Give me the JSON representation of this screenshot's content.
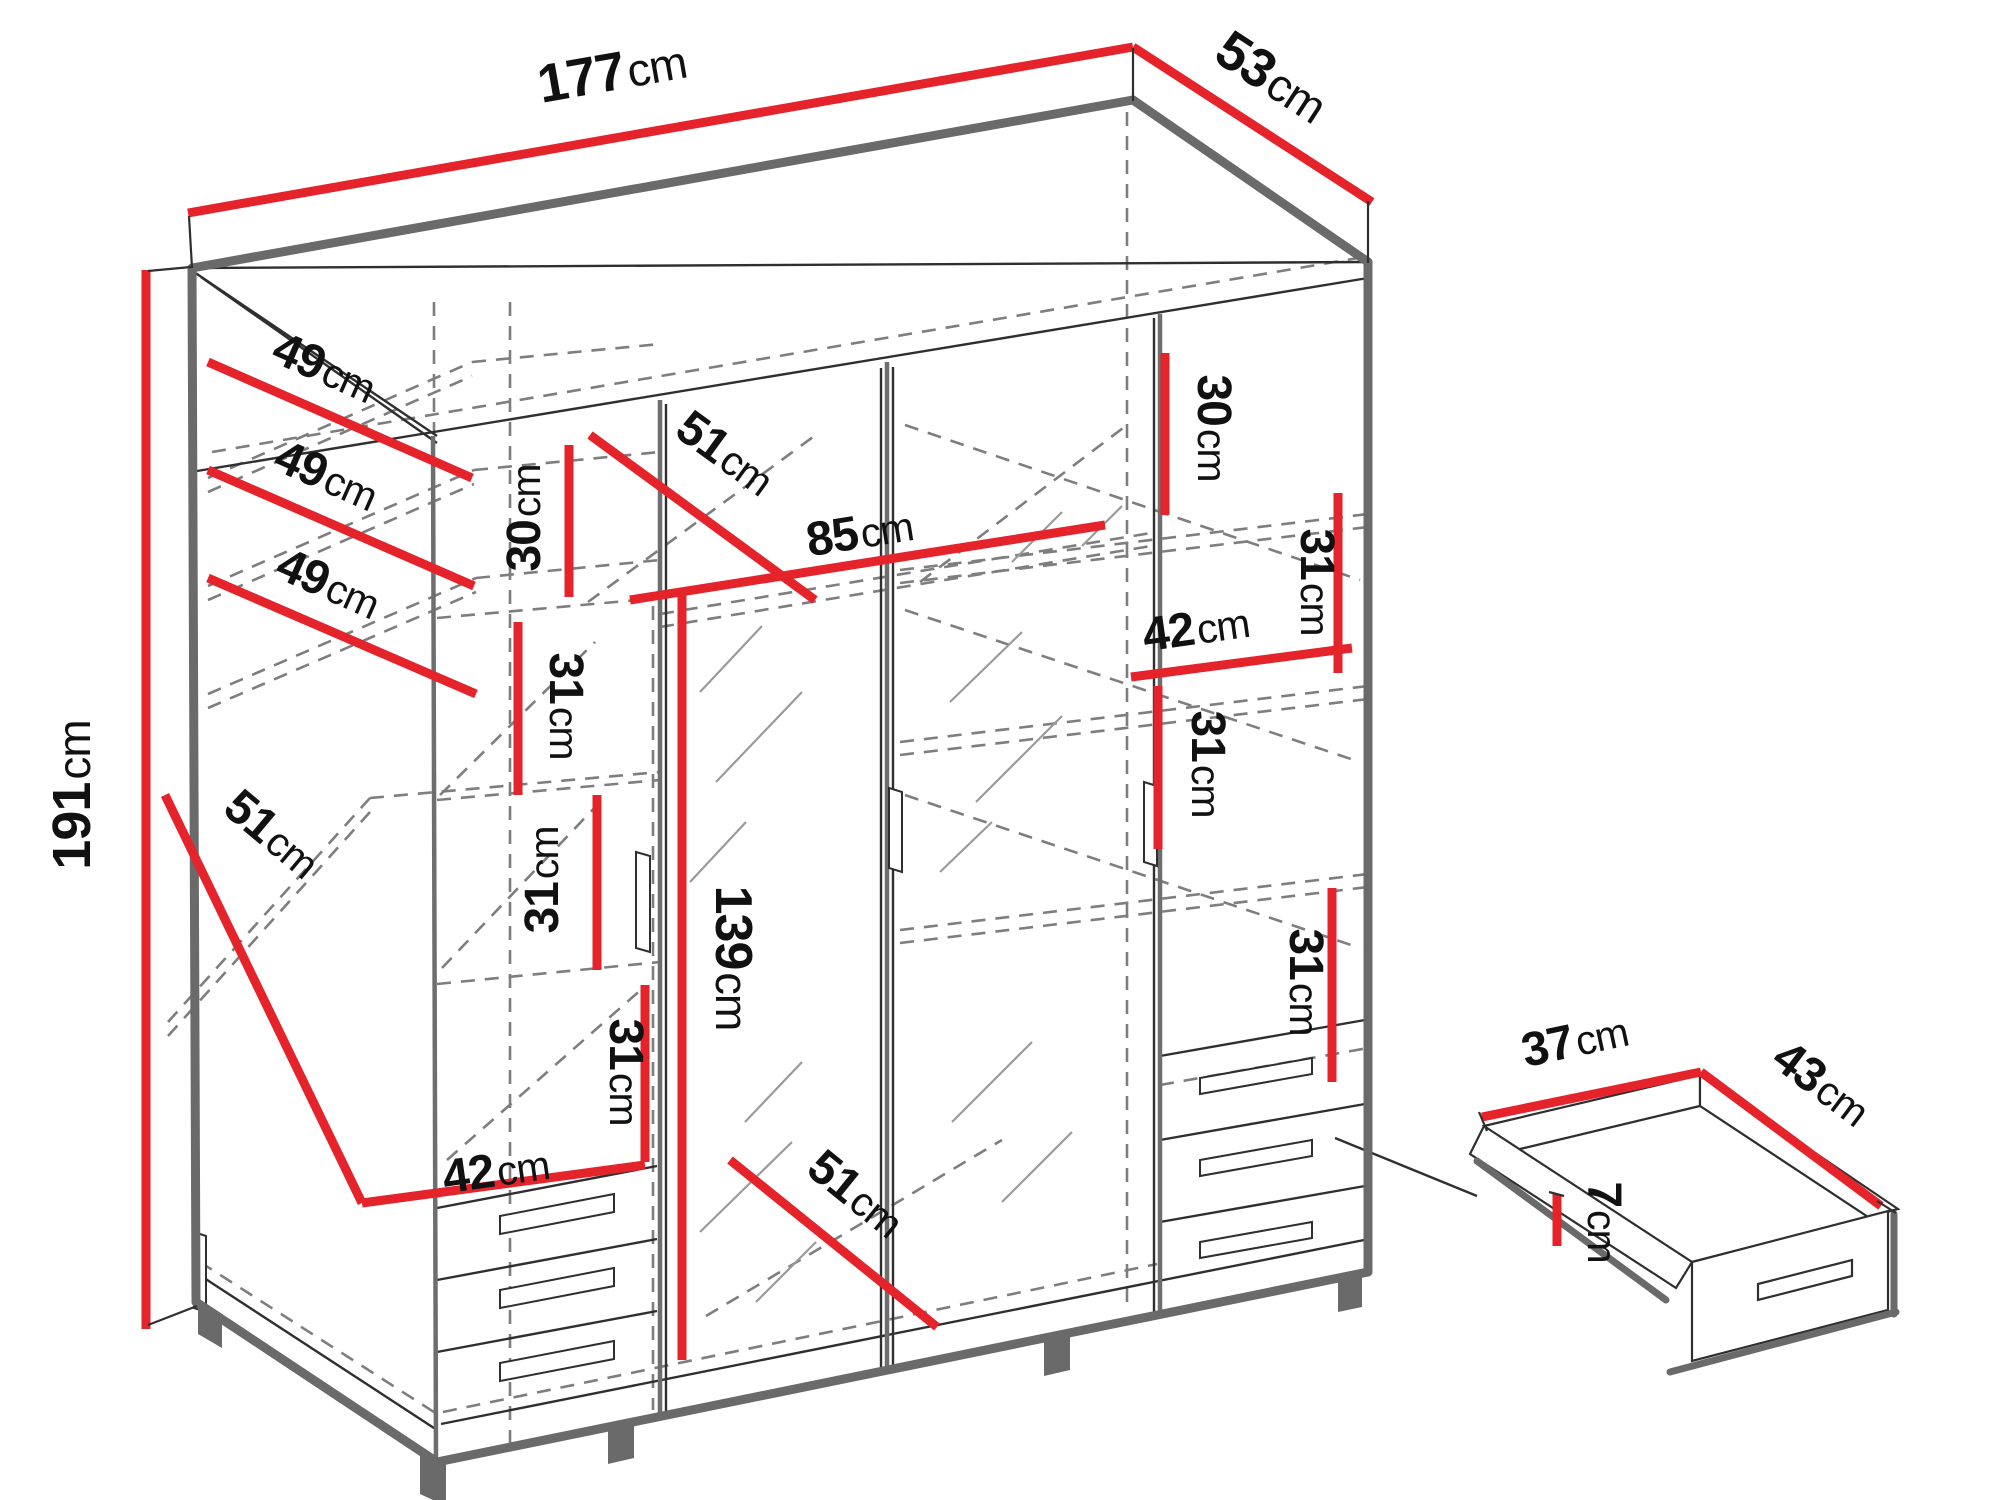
{
  "colors": {
    "red": "#e4232b",
    "thick_gray": "#6a6a6a",
    "thin_black": "#2f2f2f",
    "dash_gray": "#7e7e7e",
    "hatch_gray": "#9a9a9a"
  },
  "diagram": {
    "labels": [
      {
        "id": "width-total",
        "num": "177",
        "unit": "cm",
        "x": 615,
        "y": 90,
        "rot": -10,
        "size": 54
      },
      {
        "id": "depth-total",
        "num": "53",
        "unit": "cm",
        "x": 1262,
        "y": 92,
        "rot": 33,
        "size": 54
      },
      {
        "id": "height-total",
        "num": "191",
        "unit": "cm",
        "x": 90,
        "y": 795,
        "rot": -90,
        "size": 54
      },
      {
        "id": "shelf-depth-1",
        "num": "49",
        "unit": "cm",
        "x": 318,
        "y": 382,
        "rot": 24,
        "size": 48
      },
      {
        "id": "shelf-depth-2",
        "num": "49",
        "unit": "cm",
        "x": 320,
        "y": 490,
        "rot": 24,
        "size": 48
      },
      {
        "id": "shelf-depth-3",
        "num": "49",
        "unit": "cm",
        "x": 322,
        "y": 598,
        "rot": 24,
        "size": 48
      },
      {
        "id": "shelf-depth-4",
        "num": "51",
        "unit": "cm",
        "x": 262,
        "y": 846,
        "rot": 40,
        "size": 48
      },
      {
        "id": "left-h-30",
        "num": "30",
        "unit": "cm",
        "x": 540,
        "y": 518,
        "rot": -90,
        "size": 48
      },
      {
        "id": "left-h-31a",
        "num": "31",
        "unit": "cm",
        "x": 550,
        "y": 706,
        "rot": 90,
        "size": 48
      },
      {
        "id": "left-h-31b",
        "num": "31",
        "unit": "cm",
        "x": 558,
        "y": 880,
        "rot": -90,
        "size": 48
      },
      {
        "id": "left-h-31c",
        "num": "31",
        "unit": "cm",
        "x": 610,
        "y": 1072,
        "rot": 90,
        "size": 48
      },
      {
        "id": "left-w-42",
        "num": "42",
        "unit": "cm",
        "x": 498,
        "y": 1186,
        "rot": -8,
        "size": 48
      },
      {
        "id": "mid-diag-51",
        "num": "51",
        "unit": "cm",
        "x": 716,
        "y": 466,
        "rot": 36,
        "size": 48
      },
      {
        "id": "mid-w-85",
        "num": "85",
        "unit": "cm",
        "x": 862,
        "y": 548,
        "rot": -9,
        "size": 48
      },
      {
        "id": "mirror-h-139",
        "num": "139",
        "unit": "cm",
        "x": 716,
        "y": 958,
        "rot": 90,
        "size": 52
      },
      {
        "id": "mid-diag-51b",
        "num": "51",
        "unit": "cm",
        "x": 846,
        "y": 1206,
        "rot": 39,
        "size": 48
      },
      {
        "id": "right-h-30",
        "num": "30",
        "unit": "cm",
        "x": 1198,
        "y": 428,
        "rot": 90,
        "size": 48
      },
      {
        "id": "right-h-31a",
        "num": "31",
        "unit": "cm",
        "x": 1301,
        "y": 582,
        "rot": 90,
        "size": 48
      },
      {
        "id": "right-w-42",
        "num": "42",
        "unit": "cm",
        "x": 1198,
        "y": 644,
        "rot": -8,
        "size": 48
      },
      {
        "id": "right-h-31b",
        "num": "31",
        "unit": "cm",
        "x": 1192,
        "y": 764,
        "rot": 90,
        "size": 48
      },
      {
        "id": "right-h-31c",
        "num": "31",
        "unit": "cm",
        "x": 1290,
        "y": 982,
        "rot": 90,
        "size": 48
      },
      {
        "id": "drawer-w-37",
        "num": "37",
        "unit": "cm",
        "x": 1578,
        "y": 1056,
        "rot": -12,
        "size": 48
      },
      {
        "id": "drawer-d-43",
        "num": "43",
        "unit": "cm",
        "x": 1812,
        "y": 1096,
        "rot": 37,
        "size": 48
      },
      {
        "id": "drawer-h-7",
        "num": "7",
        "unit": "cm",
        "x": 1588,
        "y": 1222,
        "rot": 90,
        "size": 48
      }
    ],
    "red_lines": [
      {
        "id": "width-total",
        "pts": [
          188,
          213,
          1133,
          47
        ]
      },
      {
        "id": "depth-total",
        "pts": [
          1133,
          47,
          1372,
          202
        ]
      },
      {
        "id": "height-total",
        "pts": [
          146,
          270,
          146,
          1329
        ]
      },
      {
        "id": "shelf-depth-1",
        "pts": [
          208,
          362,
          472,
          478
        ]
      },
      {
        "id": "shelf-depth-2",
        "pts": [
          208,
          470,
          474,
          586
        ]
      },
      {
        "id": "shelf-depth-3",
        "pts": [
          208,
          578,
          476,
          694
        ]
      },
      {
        "id": "shelf-depth-4",
        "pts": [
          165,
          795,
          362,
          1203
        ]
      },
      {
        "id": "left-w-42",
        "pts": [
          362,
          1203,
          645,
          1165
        ]
      },
      {
        "id": "left-h-30",
        "pts": [
          569,
          445,
          569,
          597
        ]
      },
      {
        "id": "left-h-31a",
        "pts": [
          518,
          622,
          518,
          795
        ]
      },
      {
        "id": "left-h-31b",
        "pts": [
          597,
          795,
          597,
          970
        ]
      },
      {
        "id": "left-h-31c",
        "pts": [
          645,
          985,
          645,
          1162
        ]
      },
      {
        "id": "mid-diag-51",
        "pts": [
          590,
          435,
          815,
          600
        ]
      },
      {
        "id": "mid-w-85",
        "pts": [
          630,
          600,
          1105,
          525
        ]
      },
      {
        "id": "mirror-h-139",
        "pts": [
          682,
          595,
          682,
          1360
        ]
      },
      {
        "id": "mid-diag-51b",
        "pts": [
          730,
          1160,
          937,
          1327
        ]
      },
      {
        "id": "right-h-30",
        "pts": [
          1165,
          353,
          1165,
          515
        ]
      },
      {
        "id": "right-h-31a",
        "pts": [
          1338,
          493,
          1338,
          673
        ]
      },
      {
        "id": "right-w-42",
        "pts": [
          1131,
          677,
          1352,
          648
        ]
      },
      {
        "id": "right-h-31b",
        "pts": [
          1158,
          686,
          1158,
          849
        ]
      },
      {
        "id": "right-h-31c",
        "pts": [
          1332,
          888,
          1332,
          1082
        ]
      },
      {
        "id": "drawer-w-37",
        "pts": [
          1482,
          1117,
          1701,
          1072
        ]
      },
      {
        "id": "drawer-d-43",
        "pts": [
          1701,
          1072,
          1881,
          1206
        ]
      },
      {
        "id": "drawer-h-7",
        "pts": [
          1557,
          1194,
          1557,
          1246
        ]
      }
    ],
    "ticks": [
      [
        189,
        216,
        192,
        268
      ],
      [
        1133,
        48,
        1133,
        101
      ],
      [
        1368,
        201,
        1368,
        263
      ],
      [
        148,
        271,
        191,
        267
      ],
      [
        148,
        1325,
        197,
        1306
      ],
      [
        1479,
        1112,
        1487,
        1131
      ],
      [
        1877,
        1201,
        1896,
        1213
      ],
      [
        1549,
        1192,
        1564,
        1196
      ]
    ],
    "outline": [
      [
        192,
        268,
        1133,
        100
      ],
      [
        1133,
        100,
        1368,
        262
      ],
      [
        192,
        268,
        196,
        1302
      ],
      [
        196,
        1302,
        437,
        1462
      ],
      [
        437,
        1462,
        1368,
        1272
      ],
      [
        1368,
        262,
        1368,
        1272
      ]
    ],
    "detail_thick": [
      [
        1477,
        1161,
        1666,
        1300
      ],
      [
        1670,
        1372,
        1896,
        1312
      ],
      [
        1894,
        1214,
        1894,
        1314
      ]
    ],
    "thin": [
      [
        192,
        268,
        1368,
        262
      ],
      [
        197,
        471,
        1368,
        278
      ],
      [
        194,
        272,
        437,
        436
      ],
      [
        201,
        277,
        437,
        443
      ],
      [
        666,
        404,
        666,
        1414
      ],
      [
        881,
        368,
        881,
        1368
      ],
      [
        893,
        367,
        893,
        1366
      ],
      [
        1154,
        318,
        1154,
        1312
      ],
      [
        198,
        1274,
        437,
        1430
      ],
      [
        441,
        1424,
        1364,
        1240
      ],
      [
        437,
        1208,
        657,
        1166
      ],
      [
        437,
        1280,
        657,
        1239
      ],
      [
        437,
        1352,
        657,
        1311
      ],
      [
        1160,
        1056,
        1365,
        1020
      ],
      [
        1160,
        1140,
        1365,
        1104
      ],
      [
        1160,
        1222,
        1365,
        1186
      ],
      [
        1335,
        1138,
        1477,
        1196
      ]
    ],
    "divisions": [
      [
        433,
        436,
        436,
        1460
      ],
      [
        660,
        400,
        660,
        1416
      ],
      [
        887,
        362,
        887,
        1370
      ],
      [
        1160,
        314,
        1160,
        1314
      ]
    ],
    "dashed": [
      [
        434,
        302,
        434,
        434
      ],
      [
        510,
        302,
        510,
        1446
      ],
      [
        653,
        606,
        653,
        1410
      ],
      [
        1127,
        112,
        1127,
        1306
      ],
      [
        212,
        452,
        1358,
        258
      ],
      [
        208,
        478,
        472,
        362
      ],
      [
        208,
        492,
        472,
        376
      ],
      [
        472,
        362,
        660,
        344
      ],
      [
        208,
        586,
        474,
        470
      ],
      [
        208,
        600,
        474,
        484
      ],
      [
        474,
        470,
        660,
        452
      ],
      [
        208,
        694,
        476,
        578
      ],
      [
        208,
        708,
        476,
        592
      ],
      [
        476,
        578,
        660,
        560
      ],
      [
        168,
        1022,
        370,
        798
      ],
      [
        168,
        1036,
        370,
        812
      ],
      [
        370,
        798,
        660,
        772
      ],
      [
        437,
        618,
        660,
        598
      ],
      [
        437,
        800,
        660,
        780
      ],
      [
        437,
        984,
        660,
        962
      ],
      [
        440,
        795,
        595,
        642
      ],
      [
        442,
        968,
        600,
        802
      ],
      [
        447,
        1160,
        643,
        988
      ],
      [
        200,
        1262,
        437,
        1414
      ],
      [
        443,
        1412,
        1157,
        1264
      ],
      [
        660,
        614,
        1157,
        532
      ],
      [
        660,
        627,
        1157,
        545
      ],
      [
        588,
        602,
        813,
        437
      ],
      [
        920,
        582,
        1123,
        428
      ],
      [
        660,
        1416,
        1157,
        1316
      ],
      [
        706,
        1316,
        1002,
        1140
      ],
      [
        900,
        570,
        1368,
        514
      ],
      [
        900,
        583,
        1368,
        527
      ],
      [
        900,
        742,
        1368,
        686
      ],
      [
        900,
        755,
        1368,
        699
      ],
      [
        900,
        930,
        1368,
        874
      ],
      [
        900,
        943,
        1368,
        887
      ],
      [
        1160,
        1085,
        1368,
        1048
      ],
      [
        905,
        425,
        1360,
        580
      ],
      [
        905,
        610,
        1360,
        762
      ],
      [
        905,
        795,
        1360,
        948
      ]
    ],
    "hatch": [
      [
        700,
        692,
        762,
        626
      ],
      [
        716,
        782,
        802,
        692
      ],
      [
        690,
        882,
        746,
        822
      ],
      [
        745,
        1122,
        802,
        1062
      ],
      [
        700,
        1232,
        792,
        1142
      ],
      [
        756,
        1302,
        816,
        1242
      ],
      [
        950,
        702,
        1022,
        632
      ],
      [
        976,
        802,
        1062,
        716
      ],
      [
        940,
        872,
        992,
        822
      ],
      [
        1012,
        562,
        1062,
        512
      ],
      [
        952,
        1122,
        1032,
        1042
      ],
      [
        1002,
        1202,
        1072,
        1132
      ],
      [
        1082,
        546,
        1122,
        506
      ]
    ],
    "top_face": "192,268 1133,100 1368,262",
    "door_handles": [
      "194,1232 206,1236 206,1312 194,1308",
      "636,852 650,856 650,952 636,948",
      "889,788 902,792 902,872 889,868",
      "1144,782 1157,786 1157,866 1144,862"
    ],
    "drawer_handles": [
      "500,1216 614,1194 614,1212 500,1234",
      "500,1290 614,1268 614,1286 500,1308",
      "500,1363 614,1341 614,1359 500,1381",
      "1200,1078 1312,1058 1312,1074 1200,1094",
      "1200,1160 1312,1140 1312,1156 1200,1176",
      "1200,1242 1312,1222 1312,1238 1200,1258"
    ],
    "feet": [
      "198,1305 222,1319 222,1348 198,1334",
      "420,1452 446,1464 446,1506 420,1494",
      "608,1426 634,1420 634,1458 608,1464",
      "1044,1338 1070,1332 1070,1370 1044,1376",
      "1338,1275 1362,1270 1362,1307 1338,1312"
    ],
    "detail_polys": [
      {
        "name": "drawer-detail-left-band",
        "pts": "1484,1126 1700,1075 1700,1106 1512,1151"
      },
      {
        "name": "drawer-detail-right-band",
        "pts": "1700,1075 1898,1209 1868,1217 1700,1106"
      },
      {
        "name": "drawer-detail-floor",
        "pts": "1512,1151 1700,1106 1868,1217 1692,1262"
      },
      {
        "name": "drawer-detail-left-wall",
        "pts": "1484,1126 1692,1262 1676,1288 1470,1154"
      },
      {
        "name": "drawer-detail-front",
        "pts": "1692,1262 1888,1211 1888,1310 1692,1361"
      },
      {
        "name": "drawer-detail-handle",
        "pts": "1758,1284 1852,1260 1852,1276 1758,1300"
      }
    ]
  }
}
